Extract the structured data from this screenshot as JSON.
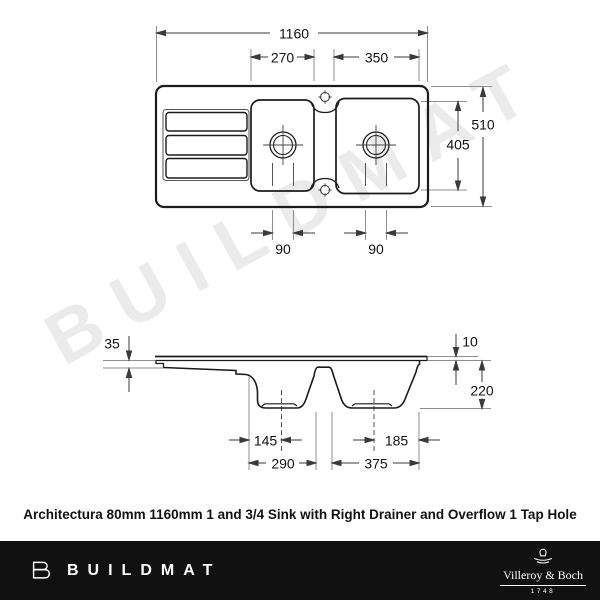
{
  "watermark": {
    "text": "BUILDMAT"
  },
  "top_view": {
    "overall_width": "1160",
    "bowl_small_width": "270",
    "bowl_large_width": "350",
    "overall_depth": "510",
    "bowl_depth": "405",
    "drain_left_diameter": "90",
    "drain_right_diameter": "90"
  },
  "section_view": {
    "rim_thickness": "35",
    "edge_thickness": "10",
    "bowl_inner_depth": "220",
    "drain_left_offset": "145",
    "drain_right_offset": "185",
    "bowl_small_width": "290",
    "bowl_large_width": "375"
  },
  "caption": "Architectura 80mm 1160mm 1 and 3/4 Sink with Right Drainer and Overflow 1 Tap Hole",
  "footer": {
    "brand": "BUILDMAT",
    "manufacturer": "Villeroy & Boch",
    "established": "1748"
  }
}
